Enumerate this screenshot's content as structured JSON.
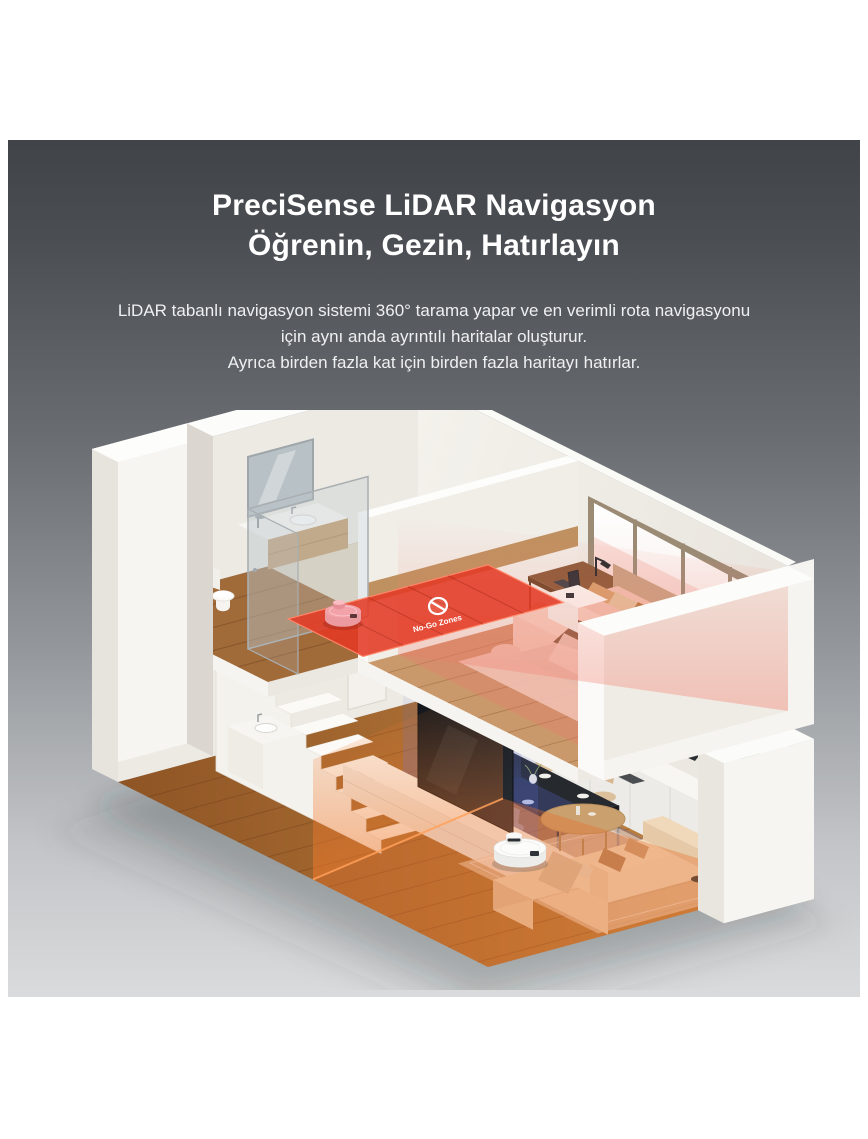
{
  "page": {
    "background": "#ffffff"
  },
  "panel": {
    "gradient_top": "#404448",
    "gradient_bottom": "#dadbdc"
  },
  "header": {
    "title_line1": "PreciSense LiDAR Navigasyon",
    "title_line2": "Öğrenin, Gezin, Hatırlayın"
  },
  "description": {
    "line1": "LiDAR tabanlı navigasyon sistemi 360° tarama yapar ve en verimli rota navigasyonu",
    "line2": "için aynı anda ayrıntılı haritalar oluşturur.",
    "line3": "Ayrıca birden fazla kat için birden fazla haritayı hatırlar."
  },
  "scene": {
    "no_go_label": "No-Go Zones",
    "colors": {
      "no_go_zone": "#e23a24",
      "scan_orange": "#e8702a",
      "scan_blue": "#5a6ed7",
      "scan_pink": "#f0786e",
      "robot_highlight": "#f2a2a8",
      "robot_body": "#fdfdfd",
      "wood_floor": "#b06a38"
    }
  }
}
